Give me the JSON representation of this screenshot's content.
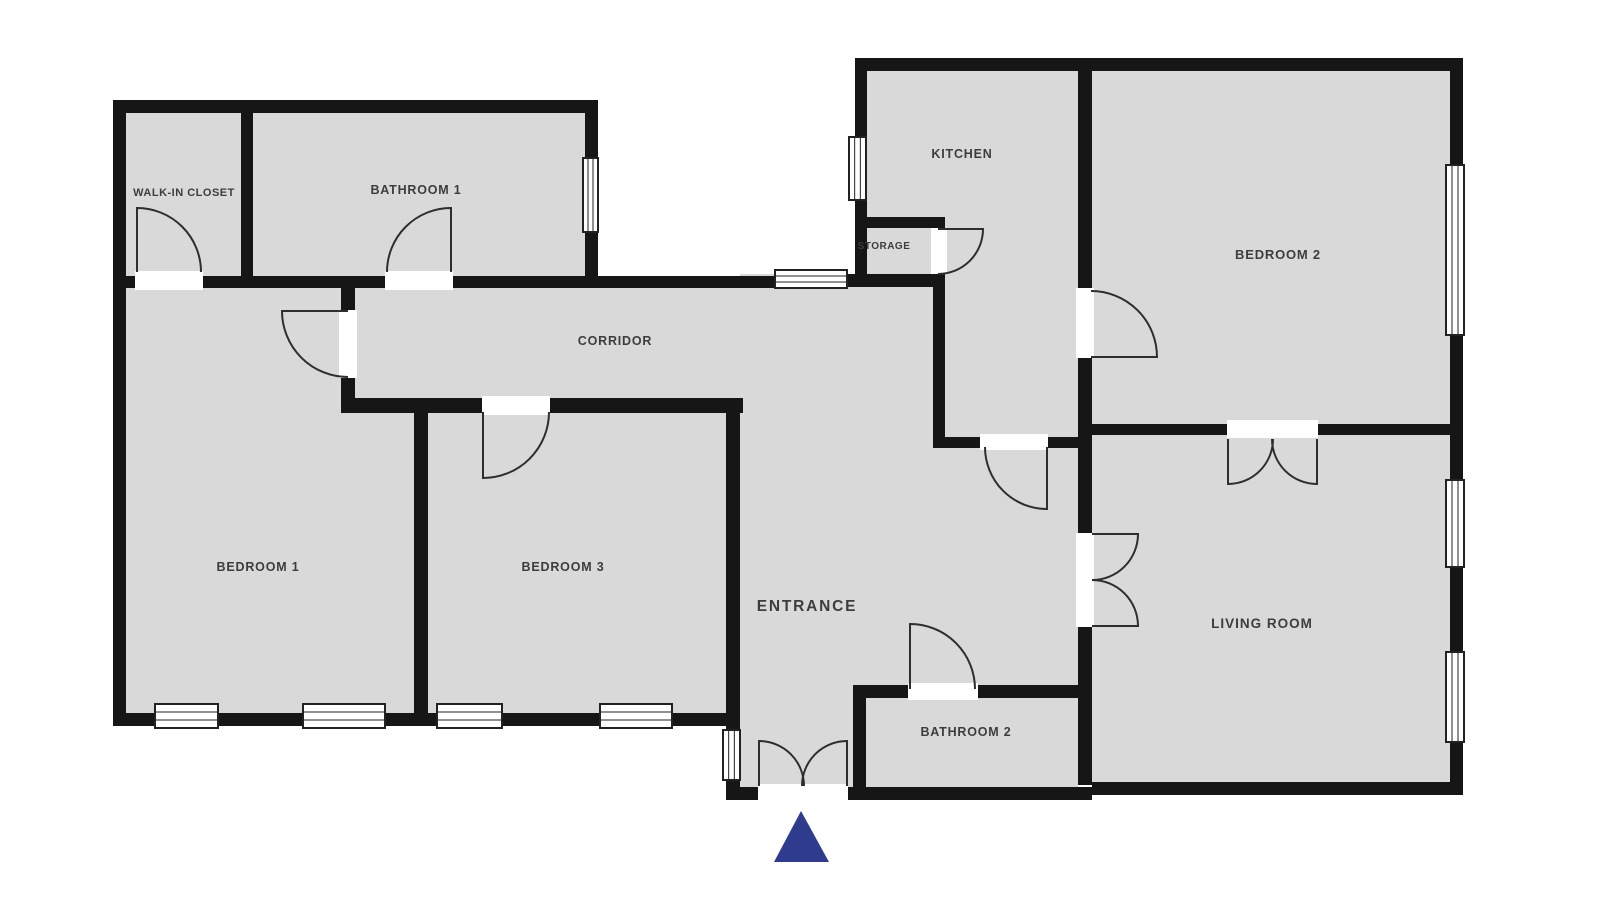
{
  "floorplan": {
    "canvas": {
      "width": 1600,
      "height": 900,
      "background": "#ffffff"
    },
    "colors": {
      "room_fill": "#d9d9d9",
      "wall": "#161616",
      "door_gap": "#ffffff",
      "arc_stroke": "#2e2e2e",
      "window_fill": "#ffffff",
      "window_stroke": "#222222",
      "label": "#3d3d3d",
      "entrance_marker": "#2f3c8d"
    },
    "rooms": [
      {
        "id": "walk-in-closet",
        "label": "WALK-IN CLOSET",
        "x": 184,
        "y": 196,
        "fs": 11,
        "ls": 0.5
      },
      {
        "id": "bathroom-1",
        "label": "BATHROOM 1",
        "x": 416,
        "y": 194,
        "fs": 12.5,
        "ls": 0.8
      },
      {
        "id": "kitchen",
        "label": "KITCHEN",
        "x": 962,
        "y": 158,
        "fs": 12.5,
        "ls": 0.8
      },
      {
        "id": "storage",
        "label": "STORAGE",
        "x": 884,
        "y": 249,
        "fs": 10,
        "ls": 0.5
      },
      {
        "id": "bedroom-2",
        "label": "BEDROOM 2",
        "x": 1278,
        "y": 259,
        "fs": 13,
        "ls": 0.8
      },
      {
        "id": "corridor",
        "label": "CORRIDOR",
        "x": 615,
        "y": 345,
        "fs": 12.5,
        "ls": 0.8
      },
      {
        "id": "bedroom-1",
        "label": "BEDROOM 1",
        "x": 258,
        "y": 571,
        "fs": 12.5,
        "ls": 0.8
      },
      {
        "id": "bedroom-3",
        "label": "BEDROOM 3",
        "x": 563,
        "y": 571,
        "fs": 12.5,
        "ls": 0.8
      },
      {
        "id": "entrance",
        "label": "ENTRANCE",
        "x": 807,
        "y": 611,
        "fs": 15.5,
        "ls": 1.8
      },
      {
        "id": "bathroom-2",
        "label": "BATHROOM 2",
        "x": 966,
        "y": 736,
        "fs": 12.5,
        "ls": 0.8
      },
      {
        "id": "living-room",
        "label": "LIVING ROOM",
        "x": 1262,
        "y": 628,
        "fs": 13.5,
        "ls": 1
      }
    ],
    "floor_rects": [
      {
        "x": 113,
        "y": 100,
        "w": 485,
        "h": 187
      },
      {
        "x": 113,
        "y": 287,
        "w": 630,
        "h": 439
      },
      {
        "x": 740,
        "y": 274,
        "w": 205,
        "h": 526
      },
      {
        "x": 855,
        "y": 71,
        "w": 223,
        "h": 727
      },
      {
        "x": 1092,
        "y": 71,
        "w": 358,
        "h": 724
      }
    ],
    "walls": [
      {
        "x": 113,
        "y": 100,
        "w": 485,
        "h": 13
      },
      {
        "x": 113,
        "y": 100,
        "w": 13,
        "h": 626
      },
      {
        "x": 585,
        "y": 113,
        "w": 13,
        "h": 174
      },
      {
        "x": 241,
        "y": 113,
        "w": 12,
        "h": 164
      },
      {
        "x": 126,
        "y": 276,
        "w": 649,
        "h": 12
      },
      {
        "x": 847,
        "y": 274,
        "w": 98,
        "h": 13
      },
      {
        "x": 341,
        "y": 287,
        "w": 14,
        "h": 126
      },
      {
        "x": 341,
        "y": 398,
        "w": 402,
        "h": 15
      },
      {
        "x": 414,
        "y": 413,
        "w": 14,
        "h": 300
      },
      {
        "x": 113,
        "y": 713,
        "w": 627,
        "h": 13
      },
      {
        "x": 726,
        "y": 398,
        "w": 14,
        "h": 402
      },
      {
        "x": 726,
        "y": 787,
        "w": 32,
        "h": 13
      },
      {
        "x": 855,
        "y": 58,
        "w": 608,
        "h": 13
      },
      {
        "x": 855,
        "y": 58,
        "w": 12,
        "h": 229
      },
      {
        "x": 867,
        "y": 217,
        "w": 75,
        "h": 11
      },
      {
        "x": 933,
        "y": 217,
        "w": 12,
        "h": 231
      },
      {
        "x": 933,
        "y": 437,
        "w": 145,
        "h": 11
      },
      {
        "x": 1078,
        "y": 71,
        "w": 14,
        "h": 714
      },
      {
        "x": 1092,
        "y": 424,
        "w": 371,
        "h": 11
      },
      {
        "x": 1450,
        "y": 58,
        "w": 13,
        "h": 737
      },
      {
        "x": 853,
        "y": 685,
        "w": 239,
        "h": 13
      },
      {
        "x": 853,
        "y": 685,
        "w": 13,
        "h": 115
      },
      {
        "x": 848,
        "y": 787,
        "w": 244,
        "h": 13
      },
      {
        "x": 1092,
        "y": 782,
        "w": 371,
        "h": 13
      }
    ],
    "door_gaps": [
      {
        "id": "closet-door-gap",
        "x": 135,
        "y": 271,
        "w": 68,
        "h": 19
      },
      {
        "id": "bathroom1-door-gap",
        "x": 385,
        "y": 271,
        "w": 68,
        "h": 19
      },
      {
        "id": "bedroom1-door-gap",
        "x": 339,
        "y": 310,
        "w": 18,
        "h": 68
      },
      {
        "id": "bedroom3-door-gap",
        "x": 482,
        "y": 396,
        "w": 68,
        "h": 19
      },
      {
        "id": "storage-door-gap",
        "x": 931,
        "y": 228,
        "w": 16,
        "h": 46
      },
      {
        "id": "kitchen-door-gap",
        "x": 980,
        "y": 434,
        "w": 68,
        "h": 16
      },
      {
        "id": "bedroom2-door-gap",
        "x": 1076,
        "y": 288,
        "w": 18,
        "h": 70
      },
      {
        "id": "living-door-gap",
        "x": 1076,
        "y": 533,
        "w": 18,
        "h": 94
      },
      {
        "id": "bedroom2-living-door-gap",
        "x": 1227,
        "y": 420,
        "w": 91,
        "h": 18
      },
      {
        "id": "bathroom2-door-gap",
        "x": 908,
        "y": 683,
        "w": 70,
        "h": 17
      },
      {
        "id": "entrance-door-gap",
        "x": 758,
        "y": 784,
        "w": 90,
        "h": 17
      }
    ],
    "door_arcs": [
      {
        "id": "closet-door",
        "d": "M137,272 L137,208 A64,64 0 0 1 201,272"
      },
      {
        "id": "bathroom1-door",
        "d": "M451,272 L451,208 A64,64 0 0 0 387,272"
      },
      {
        "id": "bedroom1-door",
        "d": "M348,311 L282,311 A66,66 0 0 0 348,377"
      },
      {
        "id": "bedroom3-door",
        "d": "M483,412 L483,478 A66,66 0 0 0 549,412"
      },
      {
        "id": "storage-door",
        "d": "M938,229 L983,229 A45,45 0 0 1 938,274"
      },
      {
        "id": "kitchen-door",
        "d": "M1047,447 L1047,509 A62,62 0 0 1 985,447"
      },
      {
        "id": "bedroom2-door",
        "d": "M1091,357 L1157,357 A66,66 0 0 0 1091,291"
      },
      {
        "id": "bathroom2-door",
        "d": "M910,689 L910,624 A65,65 0 0 1 975,689"
      },
      {
        "id": "entrance-door-left-leaf",
        "d": "M759,786 L759,741 A45,45 0 0 1 804,786"
      },
      {
        "id": "entrance-door-right-leaf",
        "d": "M847,786 L847,741 A45,45 0 0 0 802,786"
      },
      {
        "id": "bedroom2-living-left-leaf",
        "d": "M1228,439 L1228,484 A45,45 0 0 0 1273,439"
      },
      {
        "id": "bedroom2-living-right-leaf",
        "d": "M1317,439 L1317,484 A45,45 0 0 1 1272,439"
      },
      {
        "id": "living-door-top-leaf",
        "d": "M1092,534 L1138,534 A46,46 0 0 1 1092,580"
      },
      {
        "id": "living-door-bottom-leaf",
        "d": "M1092,626 L1138,626 A46,46 0 0 0 1092,580"
      }
    ],
    "windows": [
      {
        "id": "bathroom1-window",
        "x": 583,
        "y": 158,
        "w": 15,
        "h": 74,
        "orient": "v"
      },
      {
        "id": "corridor-window",
        "x": 775,
        "y": 270,
        "w": 72,
        "h": 18,
        "orient": "h"
      },
      {
        "id": "kitchen-window",
        "x": 849,
        "y": 137,
        "w": 17,
        "h": 63,
        "orient": "v"
      },
      {
        "id": "bedroom2-window",
        "x": 1446,
        "y": 165,
        "w": 18,
        "h": 170,
        "orient": "v"
      },
      {
        "id": "living-room-window-1",
        "x": 1446,
        "y": 480,
        "w": 18,
        "h": 87,
        "orient": "v"
      },
      {
        "id": "living-room-window-2",
        "x": 1446,
        "y": 652,
        "w": 18,
        "h": 90,
        "orient": "v"
      },
      {
        "id": "entrance-window",
        "x": 723,
        "y": 730,
        "w": 17,
        "h": 50,
        "orient": "v"
      },
      {
        "id": "bedroom1-window-1",
        "x": 155,
        "y": 704,
        "w": 63,
        "h": 24,
        "orient": "h"
      },
      {
        "id": "bedroom1-window-2",
        "x": 303,
        "y": 704,
        "w": 82,
        "h": 24,
        "orient": "h"
      },
      {
        "id": "bedroom3-window-1",
        "x": 437,
        "y": 704,
        "w": 65,
        "h": 24,
        "orient": "h"
      },
      {
        "id": "bedroom3-window-2",
        "x": 600,
        "y": 704,
        "w": 72,
        "h": 24,
        "orient": "h"
      }
    ],
    "entrance_marker": {
      "points": "801,811 829,862 774,862"
    }
  }
}
